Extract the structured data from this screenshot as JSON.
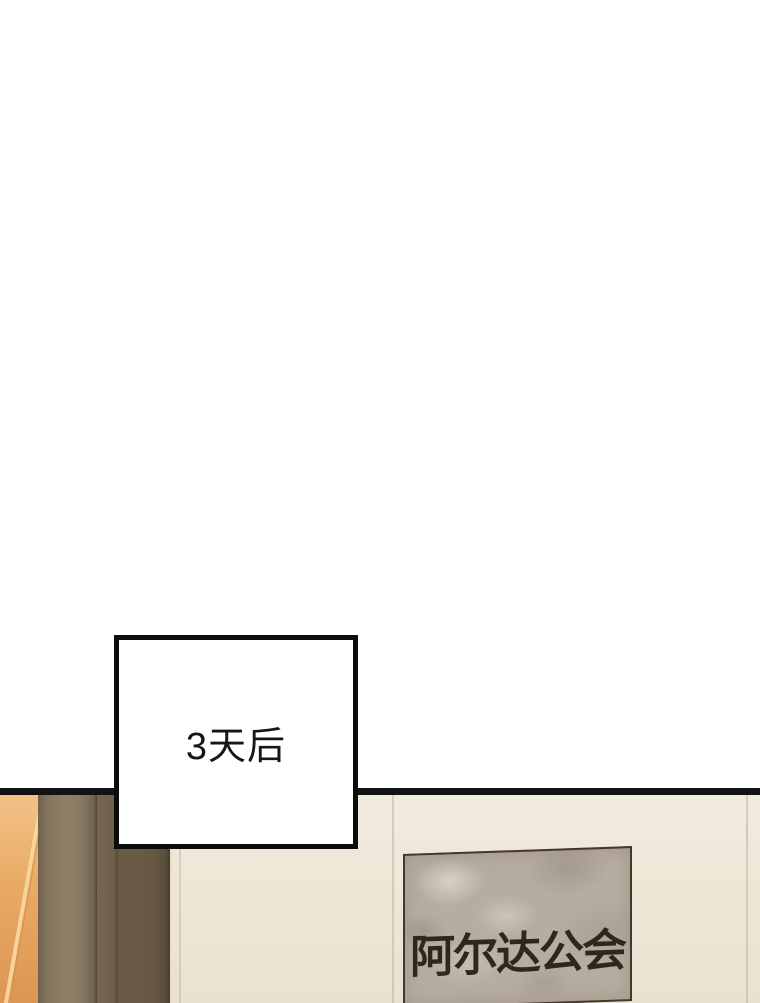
{
  "page": {
    "type": "webtoon-panel",
    "background_color": "#ffffff"
  },
  "caption_box": {
    "text": "3天后",
    "border_color": "#0c0c0c",
    "fill_color": "#ffffff",
    "text_color": "#161616"
  },
  "panel": {
    "divider_color": "#121212"
  },
  "scene": {
    "wall_color": "#eee7d8",
    "brick_color": "#e0a05f",
    "pillar_light_color": "#8e8068",
    "pillar_dark_color": "#665842"
  },
  "guild_sign": {
    "text": "阿尔达公会",
    "plaque_color": "#b6ac9f",
    "text_color": "#30261c",
    "border_color": "#453729"
  }
}
